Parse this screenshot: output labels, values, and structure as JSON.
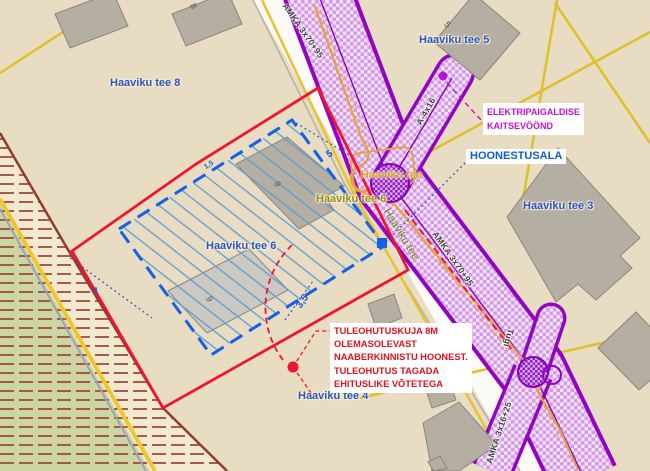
{
  "parcels": [
    {
      "id": "haaviku-tee-8",
      "text": "Haaviku tee 8"
    },
    {
      "id": "haaviku-tee-5",
      "text": "Haaviku tee 5"
    },
    {
      "id": "haaviku-tee-3",
      "text": "Haaviku tee 3"
    },
    {
      "id": "haaviku-tee-6",
      "text": "Haaviku tee 6"
    },
    {
      "id": "haaviku-tee-4",
      "text": "Haaviku tee 4"
    },
    {
      "id": "haaviku-tee-6-road",
      "text": "Haaviku tee 6"
    }
  ],
  "streets": [
    {
      "id": "street-intersection",
      "text": "Haaviku tee"
    },
    {
      "id": "street-along-road",
      "text": "Haaviku tee"
    }
  ],
  "cables": [
    {
      "id": "amka-top",
      "text": "AMKA 3x70+95"
    },
    {
      "id": "amka-mid",
      "text": "AMKA 3x70+95"
    },
    {
      "id": "branch-a4x16",
      "text": "A-4x16"
    },
    {
      "id": "amka-bottom",
      "text": "AMKA 3x16+25"
    },
    {
      "id": "pole-tugi",
      "text": "Tugi"
    }
  ],
  "dimensions": [
    {
      "id": "dim-5",
      "text": "5"
    },
    {
      "id": "dim-7",
      "text": "7"
    },
    {
      "id": "dim-3-5",
      "text": "3,5"
    },
    {
      "id": "dim-1-5",
      "text": "1,5"
    }
  ],
  "building_numbers": [
    {
      "id": "bn-8",
      "text": "8"
    },
    {
      "id": "bn-5",
      "text": "5"
    },
    {
      "id": "bn-9-upper",
      "text": "9"
    },
    {
      "id": "bn-9-lower",
      "text": "9"
    }
  ],
  "annotations": {
    "electrical_line1": "ELEKTRIPAIGALDISE",
    "electrical_line2": "KAITSEVÖÖND",
    "hoonestusala": "HOONESTUSALA",
    "fire_line1": "TULEOHUTUSKUJA 8M",
    "fire_line2": "OLEMASOLEVAST",
    "fire_line3": "NAABERKINNISTU HOONEST.",
    "fire_line4": "TULEOHUTUS TAGADA",
    "fire_line5": "EHITUSLIKE VÕTETEGA"
  },
  "colors": {
    "background": "#e8dcc2",
    "protection_zone_border": "#9105c0",
    "protection_zone_fill": "#d49ae8",
    "planning_boundary_red": "#ef1430",
    "building_area_blue": "#1560e8",
    "parcel_label_blue": "#2d50cc",
    "cadastral_yellow": "#ddc22c",
    "band_stripe_maroon": "#a04a40",
    "greenery_fill": "#ccd6a4",
    "building_grey": "#b5aea3",
    "cable_orange": "#e8a23c",
    "annotation_magenta": "#c410d6",
    "annotation_red": "#e0101c"
  }
}
